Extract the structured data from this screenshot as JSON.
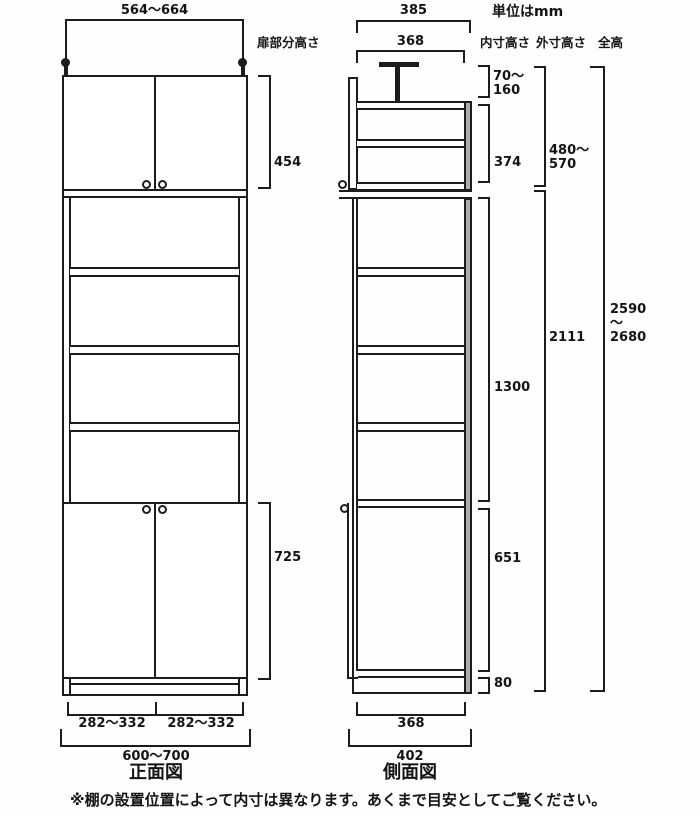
{
  "units_note": "単位はmm",
  "footnote": "※棚の設置位置によって内寸は異なります。あくまで目安としてご覧ください。",
  "front_view": {
    "title": "正面図",
    "top_width": "564～664",
    "door_label": "扉部分高さ",
    "upper_door_height": "454",
    "lower_door_height": "725",
    "left_door_width": "282～332",
    "right_door_width": "282～332",
    "total_width": "600～700"
  },
  "side_view": {
    "title": "側面図",
    "outer_depth_top": "385",
    "inner_depth_top": "368",
    "inner_depth_bottom": "368",
    "outer_depth_bottom": "402"
  },
  "columns": {
    "inner": {
      "header": "内寸高さ",
      "values": [
        "70～\n160",
        "374",
        "1300",
        "651",
        "80"
      ]
    },
    "outer": {
      "header": "外寸高さ",
      "values": [
        "480～\n570",
        "2111"
      ]
    },
    "total": {
      "header": "全高",
      "values": [
        "2590\n～\n2680"
      ]
    }
  },
  "colors": {
    "line": "#1c1c1c",
    "back_panel": "#a7b1b1"
  }
}
